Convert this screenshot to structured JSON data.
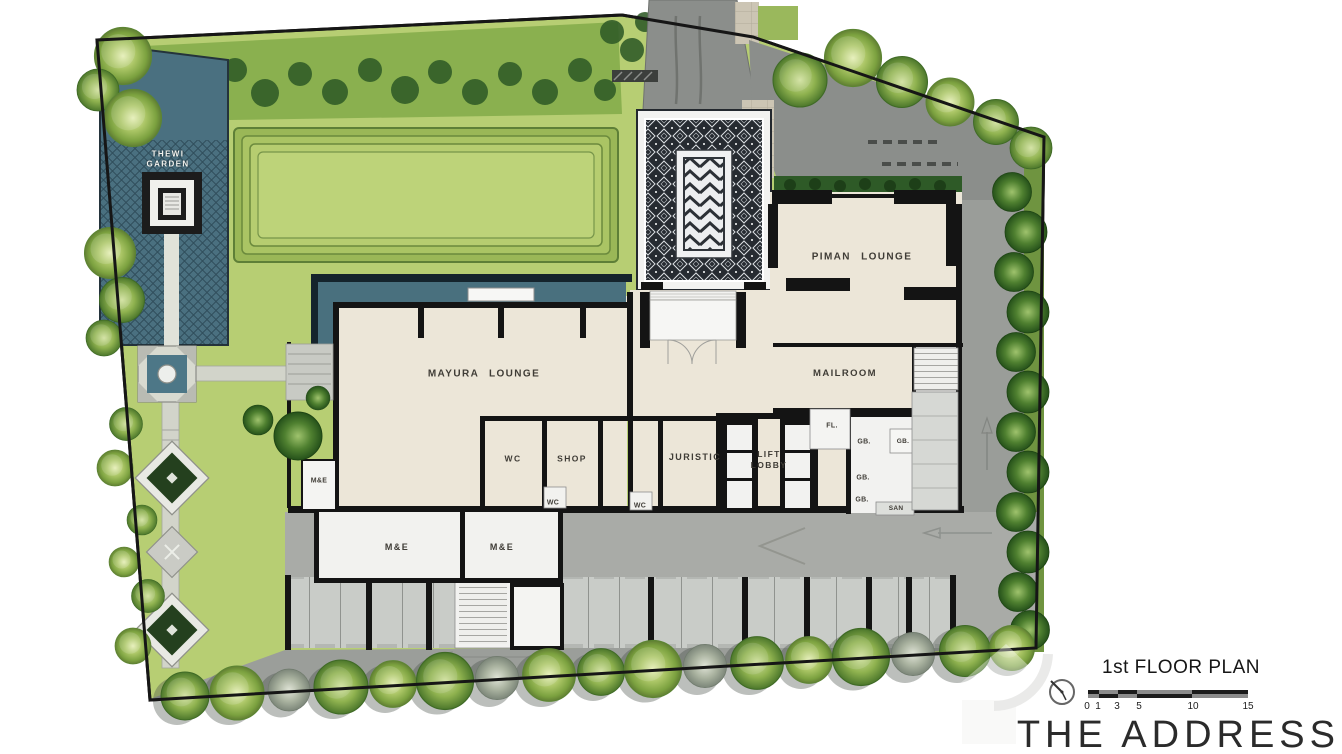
{
  "labels": {
    "thewi_garden": "THEWI\nGARDEN",
    "piman_lounge": "PIMAN LOUNGE",
    "mayura_lounge": "MAYURA LOUNGE",
    "mailroom": "MAILROOM",
    "wc": "WC",
    "shop": "SHOP",
    "juristic": "JURISTIC",
    "lift_lobby": "LIFT\nLOBBY",
    "fl": "FL.",
    "gb": "GB.",
    "san": "SAN",
    "me": "M&E"
  },
  "title_block": {
    "plan_title": "1st FLOOR PLAN",
    "brand": "THE ADDRESS",
    "scale_ticks": [
      "0",
      "1",
      "3",
      "5",
      "10",
      "15"
    ]
  },
  "colors": {
    "building_fill": "#ece6d8",
    "water_teal": "#4a7080",
    "lawn_green": "#b7ce73",
    "road_gray": "#8b8e8b",
    "wall_black": "#141414",
    "hedge_dark": "#2f5b27"
  }
}
